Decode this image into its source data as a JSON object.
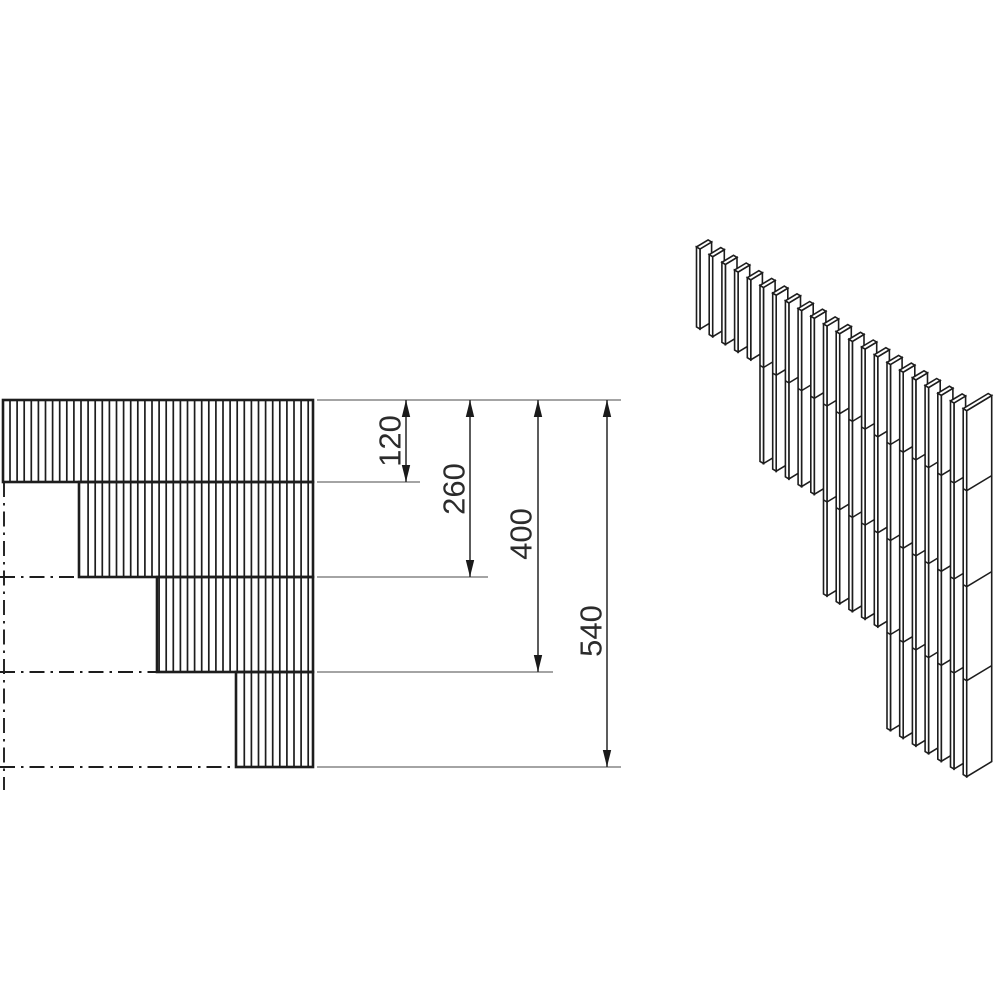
{
  "drawing": {
    "kind": "technical-drawing",
    "subject": "stepped-slat-corner-wall",
    "views": {
      "front_view_name": "front-elevation",
      "iso_view_name": "isometric-view"
    }
  },
  "colors": {
    "background": "#ffffff",
    "line": "#1d1d1d",
    "dim_line": "#333333",
    "ext_line": "#6e6e6e",
    "arrow": "#1a1a1a",
    "text": "#2b2b2b",
    "face_fill": "#ffffff"
  },
  "front_view": {
    "right_x": 313,
    "datum_y": 400,
    "hatch_start_x": 10,
    "hatch_pitch": 7.1,
    "bands": [
      {
        "name": "band-120",
        "x": 3,
        "y": 400,
        "w": 310,
        "h": 82
      },
      {
        "name": "band-260",
        "x": 79,
        "y": 482,
        "w": 234,
        "h": 95
      },
      {
        "name": "band-400",
        "x": 157,
        "y": 577,
        "w": 156,
        "h": 95
      },
      {
        "name": "band-540",
        "x": 236,
        "y": 672,
        "w": 77,
        "h": 95
      }
    ],
    "centerlines": {
      "vertical": {
        "x": 4,
        "y1": 482,
        "y2": 790
      },
      "horizontal": [
        {
          "y": 577,
          "x1": 0,
          "x2": 79
        },
        {
          "y": 672,
          "x1": 0,
          "x2": 157
        },
        {
          "y": 767,
          "x1": 0,
          "x2": 236
        }
      ]
    }
  },
  "dimensions": {
    "ext_start_x": 317,
    "top_ext": {
      "y": 400,
      "x1": 317,
      "x2": 621
    },
    "items": [
      {
        "label": "120",
        "value_mm": 120,
        "line_x": 406,
        "y_top": 400,
        "y_bottom": 482,
        "ext_end_x": 420,
        "label_x": 390,
        "label_y": 441
      },
      {
        "label": "260",
        "value_mm": 260,
        "line_x": 470,
        "y_top": 400,
        "y_bottom": 577,
        "ext_end_x": 488,
        "label_x": 454,
        "label_y": 489
      },
      {
        "label": "400",
        "value_mm": 400,
        "line_x": 538,
        "y_top": 400,
        "y_bottom": 672,
        "ext_end_x": 553,
        "label_x": 521,
        "label_y": 534
      },
      {
        "label": "540",
        "value_mm": 540,
        "line_x": 607,
        "y_top": 400,
        "y_bottom": 767,
        "ext_end_x": 621,
        "label_x": 591,
        "label_y": 631
      }
    ],
    "arrow": {
      "length": 17,
      "half_width": 4.2
    }
  },
  "iso_view": {
    "origin": [
      700,
      249
    ],
    "step": [
      12.7,
      7.7
    ],
    "slat": {
      "thin_w": 3.5,
      "thin_rise": 2.1,
      "wide_w": 11.6,
      "wide_rise": 7.0
    },
    "groups": [
      {
        "count": 5,
        "height": 80
      },
      {
        "count": 5,
        "height": 176
      },
      {
        "count": 5,
        "height": 270
      },
      {
        "count": 6,
        "height": 366
      }
    ],
    "joint_depths": [
      80,
      176,
      270
    ],
    "corner": {
      "wide_w": 25,
      "wide_rise": 15.1,
      "height": 366
    }
  }
}
